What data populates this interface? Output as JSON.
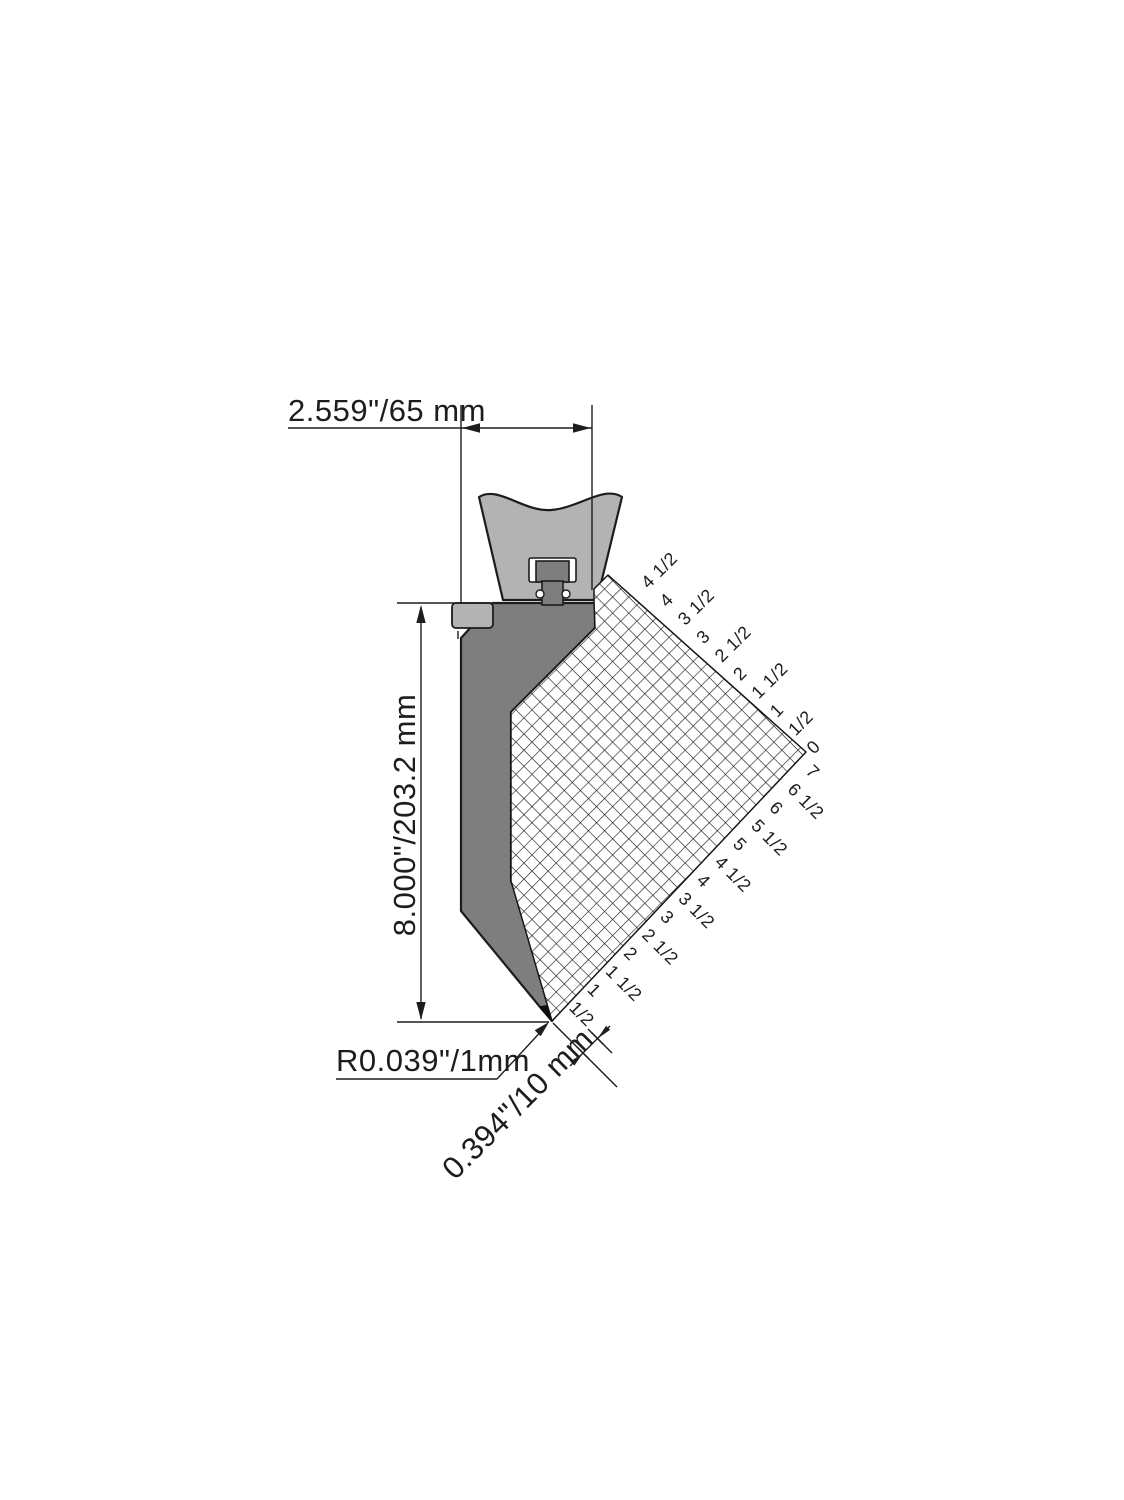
{
  "figure": {
    "title": "press-brake-punch-dimension-drawing",
    "dimensions": {
      "width_label": "2.559\"/65 mm",
      "height_label": "8.000\"/203.2 mm",
      "tip_radius_label": "R0.039\"/1mm",
      "nose_width_label": "0.394\"/10 mm"
    },
    "ruler": {
      "top_labels": [
        "4 1/2",
        "4",
        "3 1/2",
        "3",
        "2 1/2",
        "2",
        "1 1/2",
        "1",
        "1/2",
        "0"
      ],
      "bottom_labels": [
        "7",
        "6 1/2",
        "6",
        "5 1/2",
        "5",
        "4 1/2",
        "4",
        "3 1/2",
        "3",
        "2 1/2",
        "2",
        "1 1/2",
        "1",
        "1/2"
      ]
    },
    "colors": {
      "clamp": "#b3b3b3",
      "punch": "#7e7e7e",
      "tip": "#0d0d0d",
      "outline": "#1c1c1c",
      "grid_bg": "#ffffff",
      "grid_line": "#161616",
      "dim_line": "#1d1d1d"
    }
  }
}
